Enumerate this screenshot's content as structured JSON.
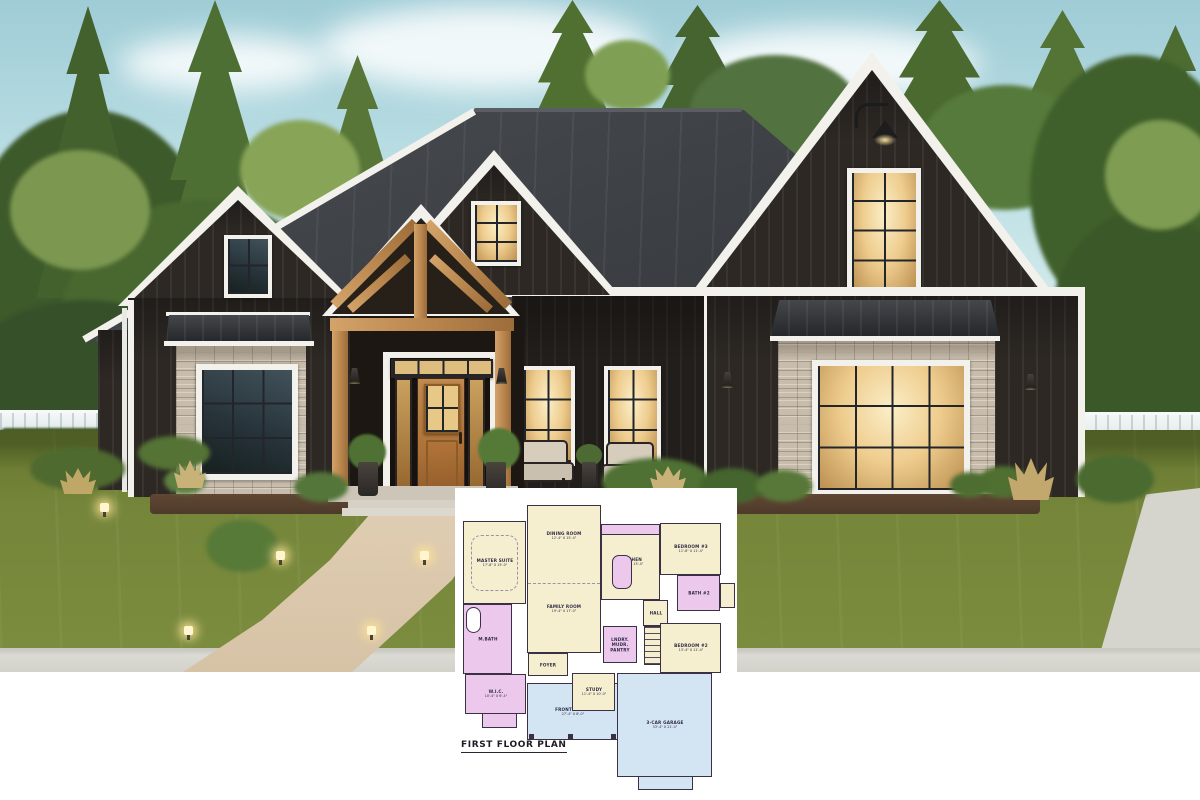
{
  "palette": {
    "sky": "#bfe1e6",
    "trees_dark": "#3d5a2a",
    "trees_light": "#7c9850",
    "lawn": "#75863a",
    "roof": "#3b3f43",
    "siding": "#2d2824",
    "trim_white": "#f2f1ec",
    "stone": "#c8bdac",
    "wood": "#c49560",
    "walkway": "#dcc9ad",
    "sidewalk": "#d8d7d1",
    "window_glow": "#eecc8d",
    "plan_wall": "#3a3145",
    "plan_cream": "#f5efcf",
    "plan_pink": "#ecc9ec",
    "plan_blue": "#d3e5f2",
    "plan_bg": "#ffffff"
  },
  "floor_plan": {
    "title": "FIRST FLOOR PLAN",
    "fills": {
      "cream": "#f5efcf",
      "pink": "#ecc9ec",
      "blue": "#d3e5f2",
      "white": "#ffffff",
      "wall": "#3a3145",
      "none": "transparent"
    },
    "rooms": [
      {
        "l": "FRONT PORCH",
        "d": "27'-4\" X 8'-0\"",
        "x": 65,
        "y": 178,
        "w": 91,
        "h": 57,
        "f": "blue"
      },
      {
        "l": "3-CAR GARAGE",
        "d": "33'-4\" X 21'-4\"",
        "x": 155,
        "y": 168,
        "w": 95,
        "h": 104,
        "f": "blue"
      },
      {
        "l": "",
        "x": 176,
        "y": 271,
        "w": 55,
        "h": 14,
        "f": "blue"
      },
      {
        "l": "MASTER SUITE",
        "d": "17'-8\" X 15'-0\"",
        "x": 1,
        "y": 16,
        "w": 63,
        "h": 83,
        "f": "cream"
      },
      {
        "l": "M.BATH",
        "x": 1,
        "y": 99,
        "w": 49,
        "h": 70,
        "f": "pink"
      },
      {
        "l": "W.I.C.",
        "d": "10'-4\" X 6'-4\"",
        "x": 3,
        "y": 169,
        "w": 61,
        "h": 40,
        "f": "pink"
      },
      {
        "l": "",
        "x": 20,
        "y": 208,
        "w": 35,
        "h": 15,
        "f": "pink"
      },
      {
        "l": "DINING ROOM",
        "d": "12'-4\" X 15'-4\"",
        "x": 65,
        "y": 0,
        "w": 74,
        "h": 148,
        "f": "cream",
        "ly": 30
      },
      {
        "l": "FOYER",
        "x": 66,
        "y": 148,
        "w": 40,
        "h": 23,
        "f": "cream"
      },
      {
        "l": "KITCHEN",
        "d": "14'-0\" X 13'-4\"",
        "x": 139,
        "y": 19,
        "w": 59,
        "h": 76,
        "f": "cream"
      },
      {
        "l": "",
        "x": 139,
        "y": 19,
        "w": 59,
        "h": 11,
        "f": "pink"
      },
      {
        "l": "",
        "x": 150,
        "y": 50,
        "w": 20,
        "h": 34,
        "f": "pink",
        "r": 7
      },
      {
        "l": "HALL",
        "x": 181,
        "y": 95,
        "w": 25,
        "h": 26,
        "f": "cream"
      },
      {
        "l": "LNDRY.\nMUDR.\nPANTRY",
        "x": 141,
        "y": 121,
        "w": 34,
        "h": 37,
        "f": "pink"
      },
      {
        "l": "",
        "x": 182,
        "y": 121,
        "w": 21,
        "h": 39,
        "f": "cream",
        "stairs": true
      },
      {
        "l": "BEDROOM #3",
        "d": "11'-8\" X 11'-4\"",
        "x": 198,
        "y": 18,
        "w": 61,
        "h": 52,
        "f": "cream"
      },
      {
        "l": "BATH #2",
        "x": 215,
        "y": 70,
        "w": 43,
        "h": 36,
        "f": "pink"
      },
      {
        "l": "",
        "x": 258,
        "y": 78,
        "w": 15,
        "h": 25,
        "f": "cream"
      },
      {
        "l": "BEDROOM #2",
        "d": "13'-4\" X 11'-4\"",
        "x": 198,
        "y": 118,
        "w": 61,
        "h": 50,
        "f": "cream"
      },
      {
        "l": "STUDY",
        "d": "11'-4\" X 10'-0\"",
        "x": 110,
        "y": 168,
        "w": 43,
        "h": 38,
        "f": "cream"
      },
      {
        "l": "FAMILY ROOM",
        "d": "19'-4\" X 17'-0\"",
        "x": 65,
        "y": 78,
        "w": 74,
        "h": 52,
        "f": "none",
        "b": "none"
      }
    ],
    "decos": [
      {
        "x": 9,
        "y": 30,
        "w": 47,
        "h": 56,
        "b": "dashed",
        "r": 10
      },
      {
        "x": 4,
        "y": 102,
        "w": 15,
        "h": 26,
        "b": "solid",
        "f": "white",
        "r": 14
      },
      {
        "x": 66,
        "y": 78,
        "w": 72,
        "h": 0,
        "b": "dashtop"
      },
      {
        "x": 67,
        "y": 229,
        "w": 5,
        "h": 5,
        "f": "wall"
      },
      {
        "x": 106,
        "y": 229,
        "w": 5,
        "h": 5,
        "f": "wall"
      },
      {
        "x": 149,
        "y": 229,
        "w": 5,
        "h": 5,
        "f": "wall"
      }
    ]
  },
  "scene": {
    "clouds": [
      {
        "x": 320,
        "y": 6,
        "w": 330,
        "h": 84
      },
      {
        "x": 680,
        "y": 28,
        "w": 300,
        "h": 72
      },
      {
        "x": 120,
        "y": 36,
        "w": 210,
        "h": 56
      }
    ],
    "trees": [
      {
        "t": "blob",
        "x": -30,
        "y": 110,
        "w": 240,
        "h": 280,
        "c": "#3d5a2a"
      },
      {
        "t": "pine",
        "x": 28,
        "y": 6,
        "w": 120,
        "h": 340,
        "c": "#43612d"
      },
      {
        "t": "pine",
        "x": 140,
        "y": 0,
        "w": 150,
        "h": 360,
        "c": "#4e6f33"
      },
      {
        "t": "blob",
        "x": 60,
        "y": 200,
        "w": 280,
        "h": 250,
        "c": "#486830"
      },
      {
        "t": "pine",
        "x": 300,
        "y": 55,
        "w": 115,
        "h": 270,
        "c": "#577637"
      },
      {
        "t": "blob",
        "x": 230,
        "y": 230,
        "w": 210,
        "h": 210,
        "c": "#41602c"
      },
      {
        "t": "pine",
        "x": 515,
        "y": 0,
        "w": 115,
        "h": 165,
        "c": "#507031"
      },
      {
        "t": "pine",
        "x": 635,
        "y": 5,
        "w": 125,
        "h": 160,
        "c": "#456430"
      },
      {
        "t": "blob",
        "x": 690,
        "y": 55,
        "w": 170,
        "h": 115,
        "c": "#527240"
      },
      {
        "t": "pine",
        "x": 872,
        "y": 0,
        "w": 135,
        "h": 155,
        "c": "#4a6a30"
      },
      {
        "t": "pine",
        "x": 1000,
        "y": 10,
        "w": 125,
        "h": 190,
        "c": "#547435"
      },
      {
        "t": "blob",
        "x": 920,
        "y": 85,
        "w": 170,
        "h": 125,
        "c": "#567a3b"
      },
      {
        "t": "pine",
        "x": 1118,
        "y": 25,
        "w": 115,
        "h": 230,
        "c": "#4c6c31"
      },
      {
        "t": "blob",
        "x": 1030,
        "y": 55,
        "w": 210,
        "h": 270,
        "c": "#40602b"
      },
      {
        "t": "blob",
        "x": 1050,
        "y": 210,
        "w": 190,
        "h": 240,
        "c": "#3b5828"
      },
      {
        "t": "blob",
        "x": -40,
        "y": 300,
        "w": 250,
        "h": 170,
        "c": "#36512a"
      },
      {
        "t": "blob",
        "x": 10,
        "y": 150,
        "w": 140,
        "h": 120,
        "c": "#7c9850"
      },
      {
        "t": "blob",
        "x": 240,
        "y": 120,
        "w": 120,
        "h": 100,
        "c": "#88a457"
      },
      {
        "t": "blob",
        "x": 1105,
        "y": 120,
        "w": 110,
        "h": 110,
        "c": "#7e9c52"
      },
      {
        "t": "blob",
        "x": 585,
        "y": 40,
        "w": 85,
        "h": 70,
        "c": "#7fa054"
      }
    ],
    "bushes": [
      {
        "x": 30,
        "y": 448,
        "w": 95,
        "h": 42,
        "c": "#4e6a2f"
      },
      {
        "x": 138,
        "y": 436,
        "w": 72,
        "h": 34,
        "c": "#557335"
      },
      {
        "x": 206,
        "y": 520,
        "w": 72,
        "h": 52,
        "c": "#587a38"
      },
      {
        "x": 602,
        "y": 458,
        "w": 108,
        "h": 48,
        "c": "#4f7134"
      },
      {
        "x": 700,
        "y": 468,
        "w": 64,
        "h": 36,
        "c": "#45652e"
      },
      {
        "x": 756,
        "y": 470,
        "w": 56,
        "h": 32,
        "c": "#577838"
      },
      {
        "x": 978,
        "y": 466,
        "w": 50,
        "h": 32,
        "c": "#507032"
      },
      {
        "x": 1076,
        "y": 455,
        "w": 78,
        "h": 48,
        "c": "#4a6a30"
      },
      {
        "x": 164,
        "y": 468,
        "w": 42,
        "h": 26,
        "c": "#5e8040"
      },
      {
        "x": 294,
        "y": 472,
        "w": 54,
        "h": 30,
        "c": "#55763a"
      },
      {
        "x": 950,
        "y": 472,
        "w": 40,
        "h": 26,
        "c": "#4e6e31"
      }
    ],
    "grasses": [
      {
        "x": 174,
        "y": 460,
        "w": 32,
        "h": 28,
        "c": "#c9b277"
      },
      {
        "x": 1008,
        "y": 458,
        "w": 46,
        "h": 42,
        "c": "#c2a86c"
      },
      {
        "x": 60,
        "y": 468,
        "w": 36,
        "h": 26,
        "c": "#bfa768"
      },
      {
        "x": 650,
        "y": 466,
        "w": 36,
        "h": 26,
        "c": "#c9b277"
      }
    ],
    "path_lights": [
      {
        "x": 100,
        "y": 503
      },
      {
        "x": 276,
        "y": 551
      },
      {
        "x": 420,
        "y": 551
      },
      {
        "x": 184,
        "y": 626
      },
      {
        "x": 367,
        "y": 626
      }
    ],
    "sconces": [
      {
        "x": 349,
        "y": 368
      },
      {
        "x": 496,
        "y": 368
      },
      {
        "x": 722,
        "y": 372
      },
      {
        "x": 1025,
        "y": 374
      }
    ]
  }
}
